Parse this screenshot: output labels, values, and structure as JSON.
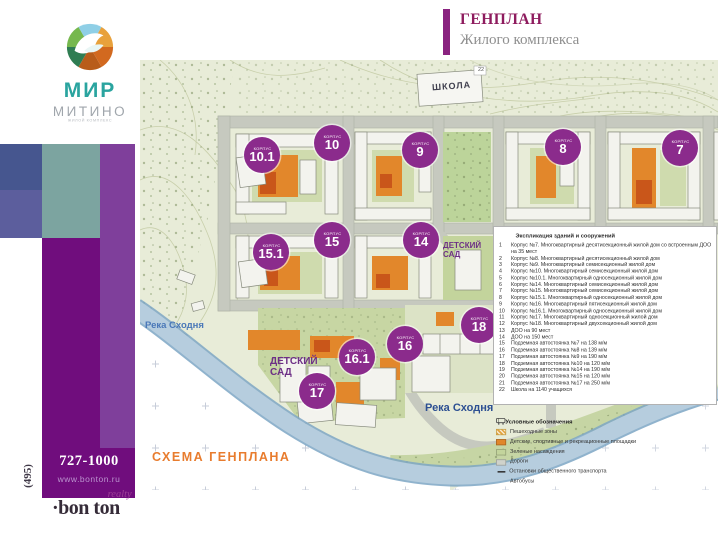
{
  "header": {
    "title": "ГЕНПЛАН",
    "subtitle": "Жилого комплекса"
  },
  "logo": {
    "brand": "МИР",
    "district": "МИТИНО",
    "tagline": "ЖИЛОЙ КОМПЛЕКС"
  },
  "contact": {
    "area_code": "(495)",
    "phone": "727-1000",
    "website": "www.bonton.ru",
    "agency": "·bon ton",
    "agency_type": "realty"
  },
  "map": {
    "marker_word": "КОРПУС",
    "school_label": "ШКОЛА",
    "school_number": "22",
    "kindergarten_label": "ДЕТСКИЙ САД",
    "river_label": "Река Сходня",
    "scheme_label": "СХЕМА ГЕНПЛАНА",
    "building_markers": [
      {
        "number": "10.1"
      },
      {
        "number": "10"
      },
      {
        "number": "9"
      },
      {
        "number": "8"
      },
      {
        "number": "7"
      },
      {
        "number": "15.1"
      },
      {
        "number": "15"
      },
      {
        "number": "14"
      },
      {
        "number": "18"
      },
      {
        "number": "16"
      },
      {
        "number": "16.1"
      },
      {
        "number": "17"
      }
    ]
  },
  "explication": {
    "title": "Экспликация зданий и сооружений",
    "items": [
      {
        "n": "1",
        "text": "Корпус №7. Многоквартирный десятисекционный жилой дом со встроенным ДОО на 35 мест"
      },
      {
        "n": "2",
        "text": "Корпус №8. Многоквартирный десятисекционный жилой дом"
      },
      {
        "n": "3",
        "text": "Корпус №9. Многоквартирный семисекционный жилой дом"
      },
      {
        "n": "4",
        "text": "Корпус №10. Многоквартирный семисекционный жилой дом"
      },
      {
        "n": "5",
        "text": "Корпус №10.1. Многоквартирный односекционный жилой дом"
      },
      {
        "n": "6",
        "text": "Корпус №14. Многоквартирный семисекционный жилой дом"
      },
      {
        "n": "7",
        "text": "Корпус №15. Многоквартирный семисекционный жилой дом"
      },
      {
        "n": "8",
        "text": "Корпус №15.1. Многоквартирный односекционный жилой дом"
      },
      {
        "n": "9",
        "text": "Корпус №16. Многоквартирный пятисекционный жилой дом"
      },
      {
        "n": "10",
        "text": "Корпус №16.1. Многоквартирный односекционный жилой дом"
      },
      {
        "n": "11",
        "text": "Корпус №17. Многоквартирный односекционный жилой дом"
      },
      {
        "n": "12",
        "text": "Корпус №18. Многоквартирный двухсекционный жилой дом"
      },
      {
        "n": "13",
        "text": "ДОО на 90 мест"
      },
      {
        "n": "14",
        "text": "ДОО на 150 мест"
      },
      {
        "n": "15",
        "text": "Подземная автостоянка №7 на 138 м/м"
      },
      {
        "n": "16",
        "text": "Подземная автостоянка №8 на 139 м/м"
      },
      {
        "n": "17",
        "text": "Подземная автостоянка №9 на 190 м/м"
      },
      {
        "n": "18",
        "text": "Подземная автостоянка №10 на 120 м/м"
      },
      {
        "n": "19",
        "text": "Подземная автостоянка №14 на 190 м/м"
      },
      {
        "n": "20",
        "text": "Подземная автостоянка №15 на 120 м/м"
      },
      {
        "n": "21",
        "text": "Подземная автостоянка №17 на 250 м/м"
      },
      {
        "n": "22",
        "text": "Школа на 1140 учащихся"
      }
    ]
  },
  "legend": {
    "title": "Условные обозначения",
    "items": [
      {
        "label": "Пешеходные зоны"
      },
      {
        "label": "Детские, спортивные и рекреационные площадки"
      },
      {
        "label": "Зеленые насаждения"
      },
      {
        "label": "Дороги"
      },
      {
        "label": "Остановки общественного транспорта"
      },
      {
        "label": "Автобусы"
      }
    ]
  },
  "colors": {
    "accent_purple": "#8b2b8c",
    "title_purple": "#8e1b5e",
    "brand_teal": "#2aa49f",
    "scheme_orange": "#e87c2e",
    "river_blue": "#2c4f92"
  }
}
